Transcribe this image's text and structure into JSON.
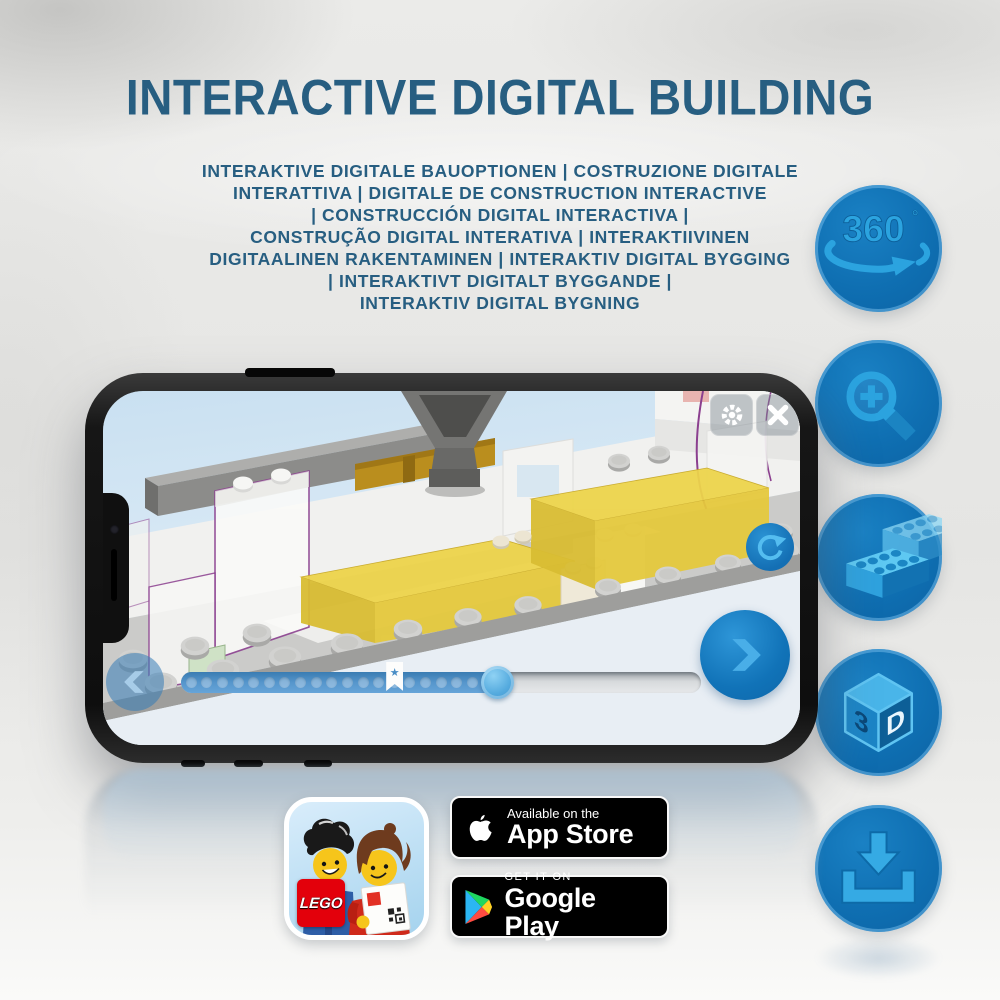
{
  "header": {
    "title": "INTERACTIVE DIGITAL BUILDING",
    "subtitle_lines": [
      "INTERAKTIVE DIGITALE BAUOPTIONEN | COSTRUZIONE DIGITALE",
      "INTERATTIVA | DIGITALE DE CONSTRUCTION INTERACTIVE",
      "| CONSTRUCCIÓN DIGITAL INTERACTIVA |",
      "CONSTRUÇÃO DIGITAL INTERATIVA | INTERAKTIIVINEN",
      "DIGITAALINEN RAKENTAMINEN | INTERAKTIV DIGITAL BYGGING",
      "| INTERAKTIVT DIGITALT BYGGANDE |",
      "INTERAKTIV DIGITAL BYGNING"
    ]
  },
  "feature_icons": {
    "rotate_360": {
      "name": "360-degree-rotation",
      "label": "360",
      "degree_symbol": "°"
    },
    "zoom_in": {
      "name": "zoom-in-magnifier"
    },
    "bricks": {
      "name": "lego-bricks"
    },
    "cube_3d": {
      "name": "3d-cube",
      "digit": "3",
      "letter": "D"
    },
    "download": {
      "name": "download-arrow-tray"
    }
  },
  "phone_app": {
    "progress_percent_complete": 61,
    "bookmark_position_percent": 41,
    "step_dots_filled": 20,
    "bookmark_star": "★",
    "controls": {
      "settings": "gear-icon",
      "close": "x-icon",
      "rotate_model": "circular-arrow-icon",
      "previous_step": "chevron-left-icon",
      "next_step": "chevron-right-icon"
    }
  },
  "store_badges": {
    "app_icon": {
      "logo_text": "LEGO"
    },
    "app_store": {
      "line1": "Available on the",
      "line2": "App Store"
    },
    "google_play": {
      "line1": "GET IT ON",
      "line2": "Google Play"
    }
  },
  "colors": {
    "title_text": "#275e81",
    "icon_circle_fill": "#0f6fb2",
    "icon_glyph": "#2ba3df",
    "progress_fill": "#5696cc",
    "badge_background": "#000000",
    "lego_red": "#e3000b",
    "brick_yellow": "#edd44b",
    "outline_purple": "#8b3f8f"
  }
}
